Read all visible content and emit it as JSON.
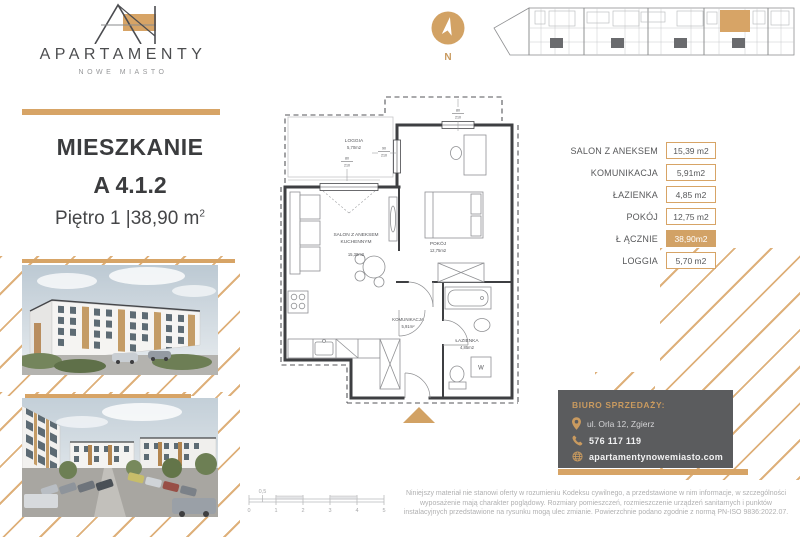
{
  "brand": {
    "name": "APARTAMENTY",
    "subtitle": "NOWE MIASTO"
  },
  "listing": {
    "type_label": "MIESZKANIE",
    "unit_number": "A 4.1.2",
    "floor_line": "Piętro 1  |38,90 m",
    "area_superscript": "2"
  },
  "compass": {
    "north_label": "N"
  },
  "area_table": {
    "rows": [
      {
        "label": "SALON Z ANEKSEM",
        "value": "15,39 m2",
        "highlight": false
      },
      {
        "label": "KOMUNIKACJA",
        "value": "5,91m2",
        "highlight": false
      },
      {
        "label": "ŁAZIENKA",
        "value": "4,85 m2",
        "highlight": false
      },
      {
        "label": "POKÓJ",
        "value": "12,75 m2",
        "highlight": false
      },
      {
        "label": "Ł ĄCZNIE",
        "value": "38,90m2",
        "highlight": true
      },
      {
        "label": "LOGGIA",
        "value": "5,70 m2",
        "highlight": false
      }
    ]
  },
  "floorplan": {
    "rooms": {
      "loggia": {
        "name": "LOGGIA",
        "area": "5,70m2"
      },
      "salon": {
        "name_line1": "SALON Z ANEKSEM",
        "name_line2": "KUCHENNYM",
        "area": "15,39m2"
      },
      "pokoj": {
        "name": "POKÓJ",
        "area": "12,75m2"
      },
      "komunikacja": {
        "name": "KOMUNIKACJA",
        "area": "5,91m²"
      },
      "lazienka": {
        "name": "ŁAZIENKA",
        "area": "4,85m2"
      }
    },
    "washer_label": "W",
    "dimensions": [
      {
        "w": "80",
        "h": "210"
      },
      {
        "w": "90",
        "h": "210"
      },
      {
        "w": "80",
        "h": "210"
      }
    ]
  },
  "sales_office": {
    "heading": "BIURO SPRZEDAŻY:",
    "address": "ul. Orla 12, Zgierz",
    "phone": "576 117 119",
    "website": "apartamentynowemiasto.com"
  },
  "scale_bar": {
    "ticks": [
      "0",
      "1",
      "2",
      "3",
      "4",
      "5"
    ],
    "half_tick": "0,5"
  },
  "disclaimer_lines": [
    "Niniejszy materiał nie stanowi oferty w rozumieniu Kodeksu cywilnego, a przedstawione w nim informacje, w szczególności",
    "wyposażenie mają charakter poglądowy. Rozmiary pomieszczeń, rozmieszczenie urządzeń sanitarnych i punktów",
    "instalacyjnych przedstawione na rysunku mogą ulec zmianie. Powierzchnie podano zgodnie z normą PN-ISO 9836:2022.07."
  ],
  "colors": {
    "gold": "#D7A466",
    "gold_light": "#DEB07A",
    "dark_text": "#3F4042",
    "box_gray": "#5B5C5E",
    "plan_line": "#3E3F42"
  }
}
